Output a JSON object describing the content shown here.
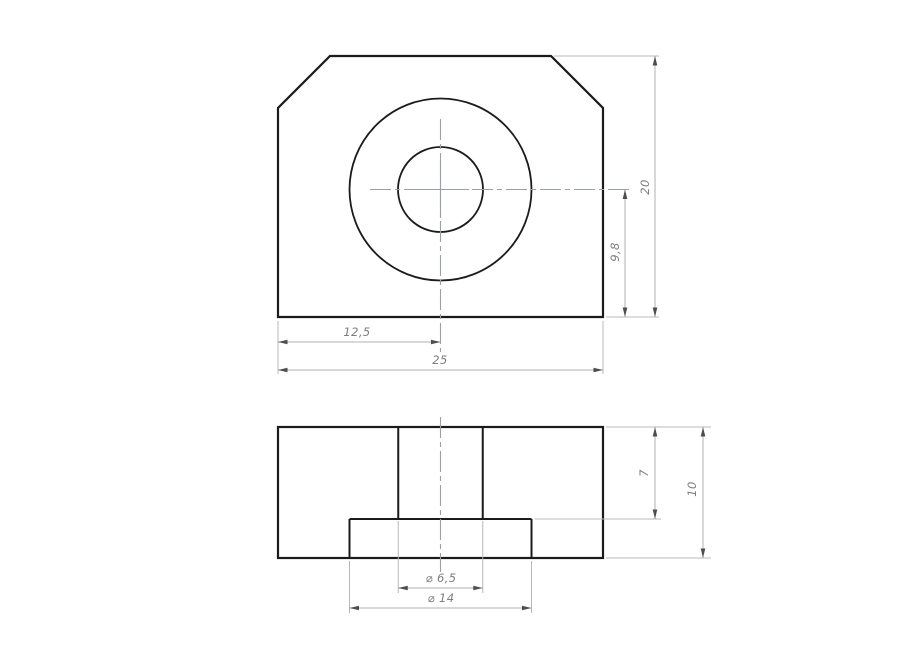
{
  "front_view": {
    "dims": {
      "center_offset_x": "12,5",
      "overall_width": "25",
      "overall_height": "20",
      "center_to_bottom": "9,8"
    }
  },
  "section_view": {
    "dims": {
      "bore_depth": "7",
      "overall_thickness": "10",
      "hole_diameter": "⌀ 6,5",
      "counterbore_diameter": "⌀ 14"
    }
  },
  "colors": {
    "background": "#ffffff",
    "part_outline": "#1b1b1b",
    "dimension_line": "#aeb1b4",
    "extension_line": "#b5b8bb",
    "centerline": "#9aa0a3",
    "arrowhead": "#4d4d4d",
    "label_text": "#7d7d80",
    "hatch_dark": "#474747",
    "hatch_light": "#a3a3a3"
  }
}
